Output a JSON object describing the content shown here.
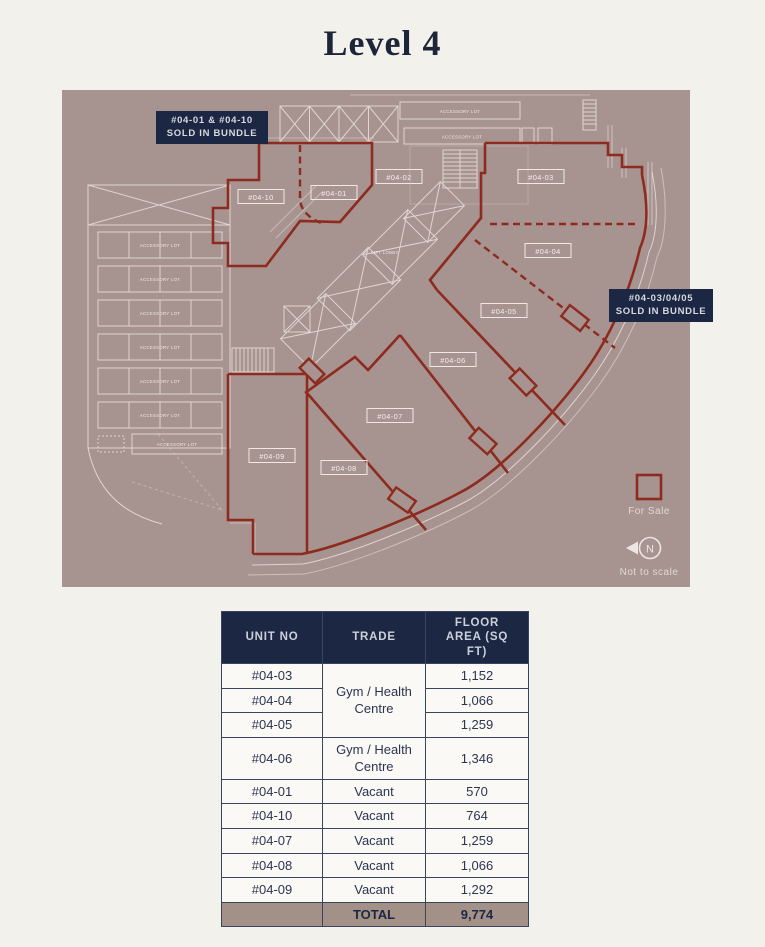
{
  "page": {
    "title": "Level 4"
  },
  "plan": {
    "background_color": "#a79390",
    "red_color": "#8e2b1f",
    "navy_color": "#1c2843",
    "callouts": [
      {
        "lines": [
          "#04-01 & #04-10",
          "SOLD IN BUNDLE"
        ]
      },
      {
        "lines": [
          "#04-03/04/05",
          "SOLD IN BUNDLE"
        ]
      }
    ],
    "units": [
      "#04-10",
      "#04-01",
      "#04-02",
      "#04-03",
      "#04-04",
      "#04-05",
      "#04-06",
      "#04-07",
      "#04-08",
      "#04-09"
    ],
    "texts": {
      "accessory_lot": "ACCESSORY LOT",
      "lift_lobby": "LIFT LOBBY"
    },
    "legend": {
      "for_sale": "For Sale",
      "north": "N",
      "not_to_scale": "Not to scale"
    }
  },
  "table": {
    "headers": [
      "UNIT NO",
      "TRADE",
      "FLOOR AREA (SQ FT)"
    ],
    "rows": [
      {
        "unit": "#04-03",
        "trade": "Gym / Health Centre",
        "area": "1,152"
      },
      {
        "unit": "#04-04",
        "area": "1,066"
      },
      {
        "unit": "#04-05",
        "area": "1,259"
      },
      {
        "unit": "#04-06",
        "trade": "Gym / Health Centre",
        "area": "1,346"
      },
      {
        "unit": "#04-01",
        "trade": "Vacant",
        "area": "570"
      },
      {
        "unit": "#04-10",
        "trade": "Vacant",
        "area": "764"
      },
      {
        "unit": "#04-07",
        "trade": "Vacant",
        "area": "1,259"
      },
      {
        "unit": "#04-08",
        "trade": "Vacant",
        "area": "1,066"
      },
      {
        "unit": "#04-09",
        "trade": "Vacant",
        "area": "1,292"
      }
    ],
    "total": {
      "label": "TOTAL",
      "value": "9,774"
    }
  }
}
